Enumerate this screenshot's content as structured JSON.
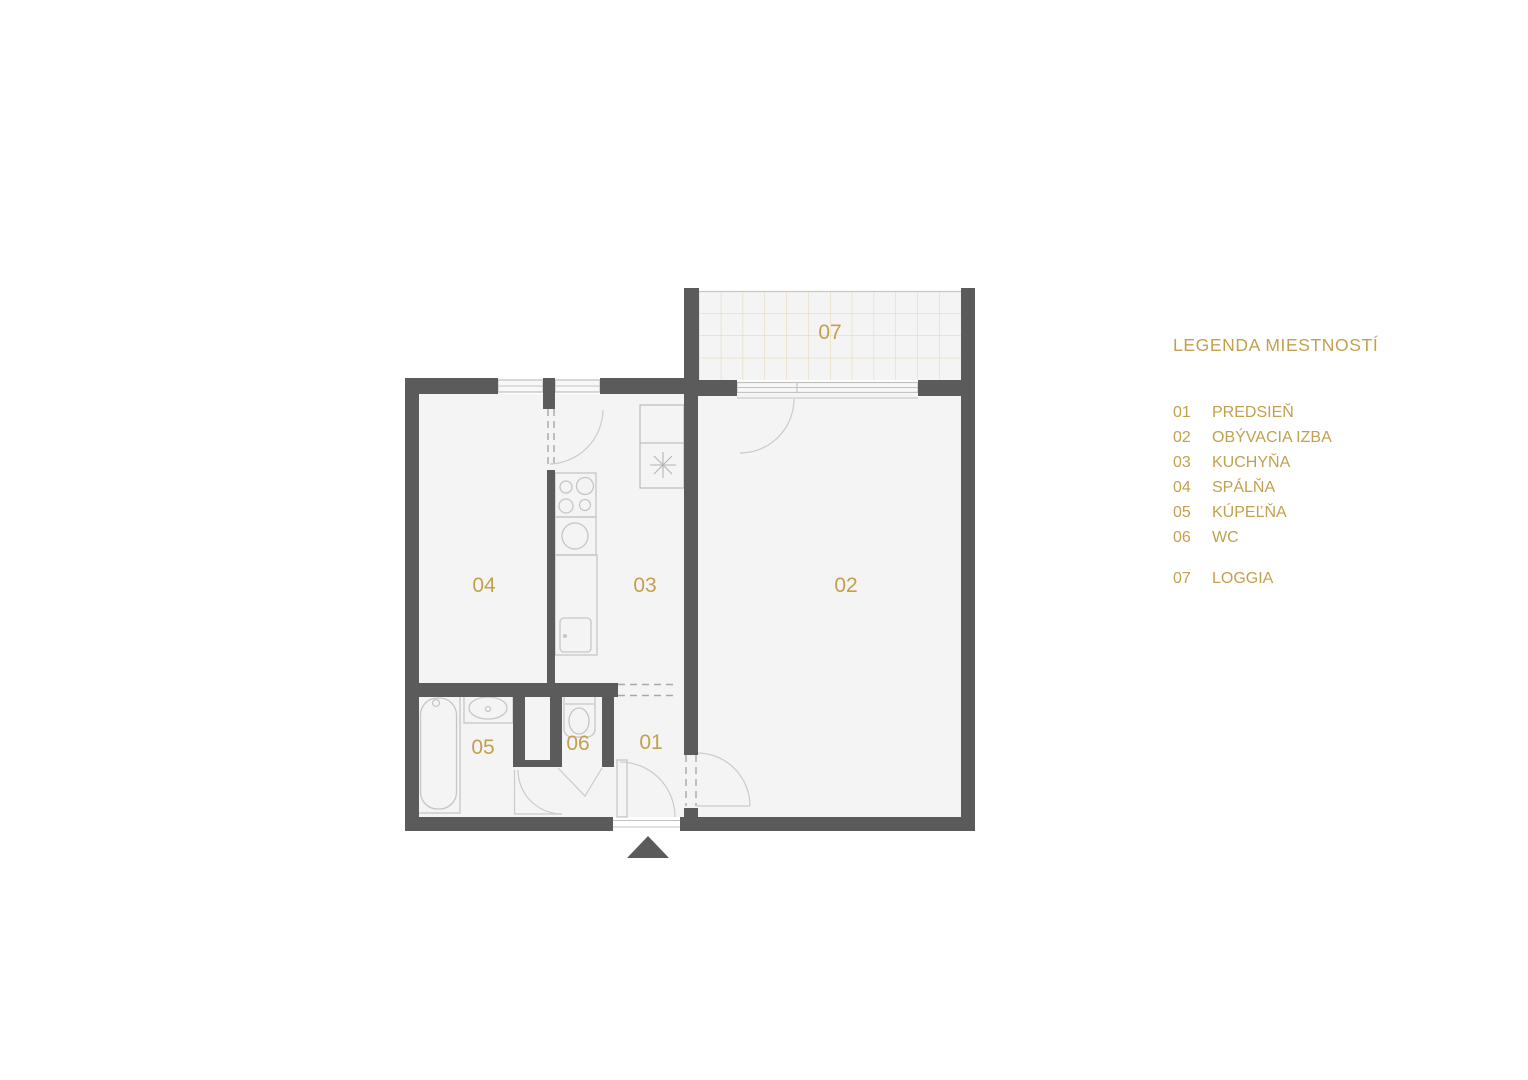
{
  "colors": {
    "accent_gold": "#C2A14E",
    "wall_gray": "#5B5B5B",
    "floor_gray": "#F4F4F4",
    "fixture_line_gray": "#C6C6C6",
    "loggia_tile_gold": "#E2D5A8"
  },
  "rooms": [
    {
      "number": "01",
      "name": "PREDSIEŇ"
    },
    {
      "number": "02",
      "name": "OBÝVACIA IZBA"
    },
    {
      "number": "03",
      "name": "KUCHYŇA"
    },
    {
      "number": "04",
      "name": "SPÁLŇA"
    },
    {
      "number": "05",
      "name": "KÚPEĽŇA"
    },
    {
      "number": "06",
      "name": "WC"
    },
    {
      "number": "07",
      "name": "LOGGIA"
    }
  ],
  "legend": {
    "title": "LEGENDA MIESTNOSTÍ"
  }
}
